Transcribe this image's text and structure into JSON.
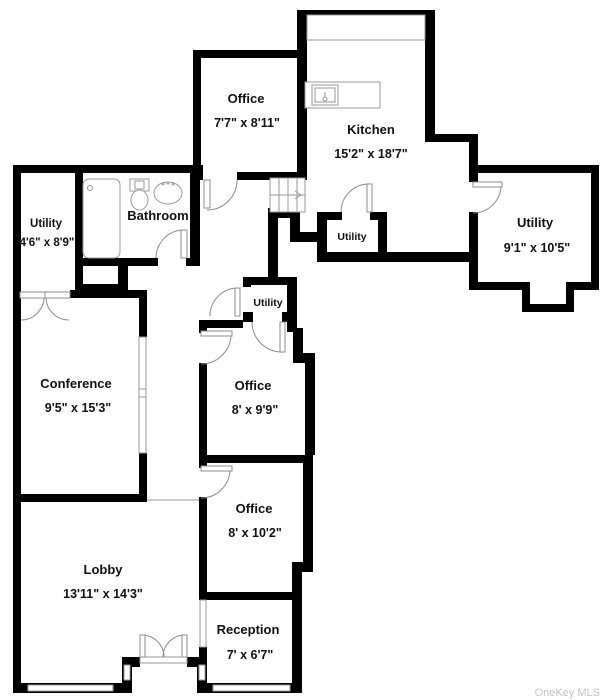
{
  "watermark": "OneKey MLS",
  "colors": {
    "wall": "#000000",
    "fixture_outline": "#9a9a9a",
    "watermark_gray": "#c4c4c4"
  },
  "rooms": {
    "office_top": {
      "name": "Office",
      "dims": "7'7\" x 8'11\""
    },
    "kitchen": {
      "name": "Kitchen",
      "dims": "15'2\" x 18'7\""
    },
    "utility_left": {
      "name": "Utility",
      "dims": "4'6\" x 8'9\""
    },
    "bathroom": {
      "name": "Bathroom"
    },
    "utility_right": {
      "name": "Utility",
      "dims": "9'1\" x 10'5\""
    },
    "utility_kitchen": {
      "name": "Utility"
    },
    "utility_middle": {
      "name": "Utility"
    },
    "conference": {
      "name": "Conference",
      "dims": "9'5\" x 15'3\""
    },
    "office_middle": {
      "name": "Office",
      "dims": "8' x 9'9\""
    },
    "office_lower": {
      "name": "Office",
      "dims": "8' x 10'2\""
    },
    "lobby": {
      "name": "Lobby",
      "dims": "13'11\" x 14'3\""
    },
    "reception": {
      "name": "Reception",
      "dims": "7' x 6'7\""
    }
  }
}
